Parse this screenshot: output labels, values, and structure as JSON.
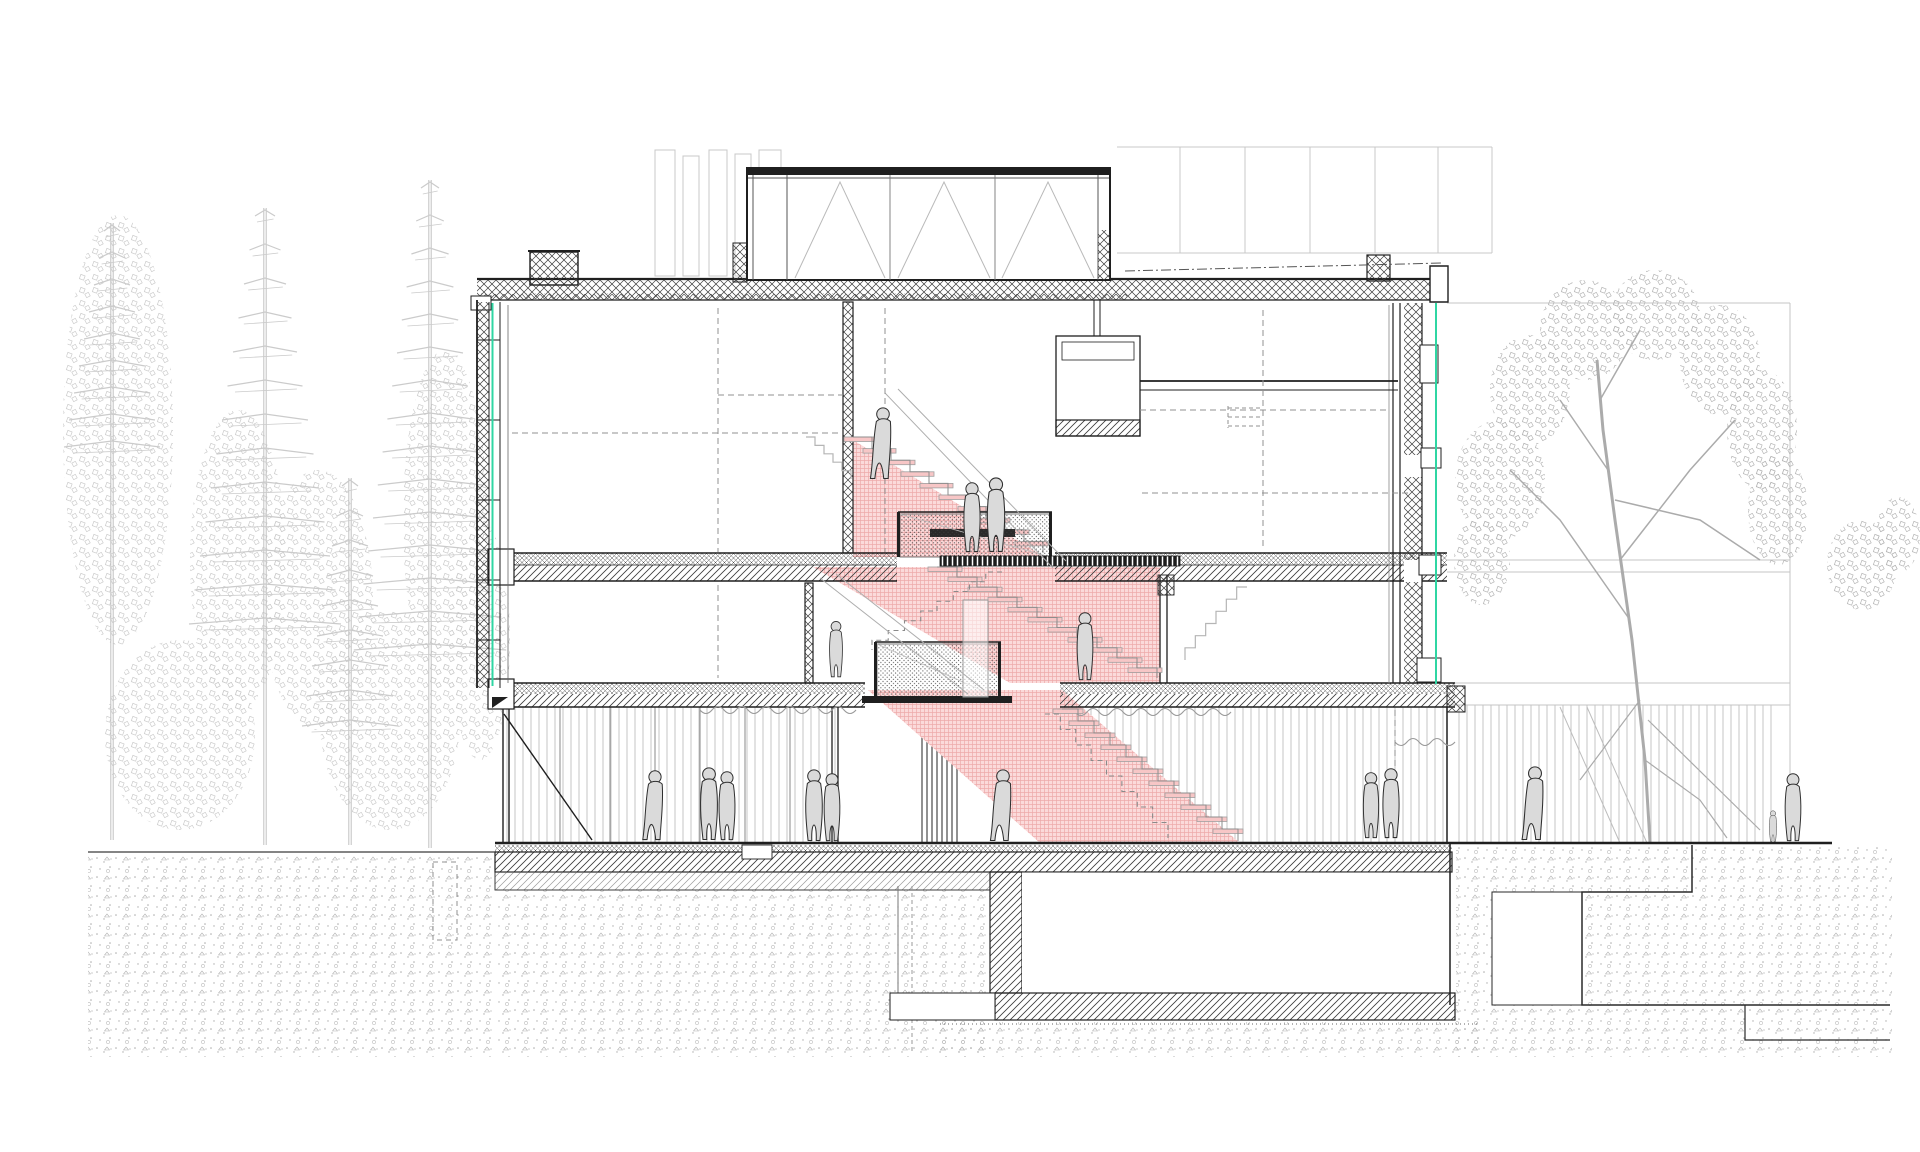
{
  "scene": {
    "description": "Architectural building cross-section drawing: three-storey timber building with a red-highlighted central staircase connecting all levels, basement below grade, conifer forest to the left, deciduous tree and neighbouring building to the right, people silhouettes on every level",
    "drawing_type": "section",
    "building": {
      "storeys": 3,
      "basement": true,
      "clerestory_bays": 3
    },
    "staircase": {
      "visible_flights": 3,
      "hidden_dashed_flights": 2,
      "highlight": "red"
    },
    "people_count": 16,
    "trees": {
      "left_conifers": 4,
      "right_deciduous": 1
    },
    "palette": {
      "line": "#1f1f1f",
      "light_line": "#c7c7c7",
      "tree_left": "#cbcbcb",
      "tree_right": "#aeaeae",
      "people_fill": "#dadada",
      "people_line": "#2f2f2f",
      "stair_mass": "#fbdada",
      "stair_grid": "#eeaaaa",
      "tread_fill": "#f7c6c6",
      "tread_edge": "#a0a0a0",
      "glazing_green": "#2fd6a3",
      "earth_dot": "#ababab",
      "dashed": "#909090"
    },
    "figures": [
      {
        "x": 883,
        "y": 480,
        "h": 74,
        "v": "walk"
      },
      {
        "x": 972,
        "y": 553,
        "h": 72,
        "v": "stand"
      },
      {
        "x": 996,
        "y": 553,
        "h": 77,
        "v": "stand"
      },
      {
        "x": 1085,
        "y": 681,
        "h": 70,
        "v": "stand"
      },
      {
        "x": 836,
        "y": 678,
        "h": 58,
        "v": "stand"
      },
      {
        "x": 655,
        "y": 841,
        "h": 72,
        "v": "walk"
      },
      {
        "x": 709,
        "y": 841,
        "h": 75,
        "v": "stand"
      },
      {
        "x": 727,
        "y": 841,
        "h": 71,
        "v": "stand"
      },
      {
        "x": 814,
        "y": 842,
        "h": 74,
        "v": "stand"
      },
      {
        "x": 832,
        "y": 842,
        "h": 70,
        "v": "stand"
      },
      {
        "x": 1003,
        "y": 842,
        "h": 74,
        "v": "walk"
      },
      {
        "x": 1371,
        "y": 839,
        "h": 68,
        "v": "stand"
      },
      {
        "x": 1391,
        "y": 839,
        "h": 72,
        "v": "stand"
      },
      {
        "x": 1535,
        "y": 841,
        "h": 76,
        "v": "walk"
      },
      {
        "x": 1793,
        "y": 842,
        "h": 70,
        "v": "stand"
      },
      {
        "x": 1773,
        "y": 842,
        "h": 32,
        "v": "stand"
      }
    ],
    "flights_solid": [
      {
        "x0": 853,
        "y0": 437,
        "x1": 1043,
        "y1": 553,
        "n": 10
      },
      {
        "x0": 937,
        "y0": 567,
        "x1": 1157,
        "y1": 678,
        "n": 11
      },
      {
        "x0": 1062,
        "y0": 709,
        "x1": 1238,
        "y1": 841,
        "n": 11
      }
    ],
    "flights_dashed": [
      {
        "x0": 1002,
        "y0": 572,
        "x1": 872,
        "y1": 650,
        "n": 8
      },
      {
        "x0": 1045,
        "y0": 714,
        "x1": 1168,
        "y1": 838,
        "n": 8
      }
    ],
    "flights_background": [
      {
        "x0": 806,
        "y0": 437,
        "x1": 851,
        "y1": 479,
        "n": 5
      },
      {
        "x0": 1247,
        "y0": 587,
        "x1": 1185,
        "y1": 660,
        "n": 6
      }
    ],
    "conifers": [
      {
        "cx": 265,
        "top": 200,
        "bot": 845,
        "tiers": 13,
        "step": 34,
        "w0": 10,
        "grow": 5.5
      },
      {
        "cx": 430,
        "top": 172,
        "bot": 848,
        "tiers": 15,
        "step": 33,
        "w0": 9,
        "grow": 4.8
      },
      {
        "cx": 350,
        "top": 470,
        "bot": 845,
        "tiers": 9,
        "step": 30,
        "w0": 8,
        "grow": 5
      },
      {
        "cx": 112,
        "top": 215,
        "bot": 840,
        "tiers": 9,
        "step": 27,
        "w0": 8,
        "grow": 5
      }
    ],
    "crowns_left": [
      {
        "cx": 118,
        "cy": 430,
        "rx": 55,
        "ry": 215
      },
      {
        "cx": 238,
        "cy": 560,
        "rx": 48,
        "ry": 150
      },
      {
        "cx": 318,
        "cy": 600,
        "rx": 55,
        "ry": 130
      },
      {
        "cx": 445,
        "cy": 520,
        "rx": 42,
        "ry": 170
      },
      {
        "cx": 180,
        "cy": 735,
        "rx": 75,
        "ry": 95
      },
      {
        "cx": 390,
        "cy": 720,
        "rx": 70,
        "ry": 110
      },
      {
        "cx": 480,
        "cy": 640,
        "rx": 30,
        "ry": 120
      }
    ],
    "clusters_right": [
      {
        "cx": 1500,
        "cy": 480,
        "rx": 45,
        "ry": 60
      },
      {
        "cx": 1530,
        "cy": 390,
        "rx": 40,
        "ry": 55
      },
      {
        "cx": 1585,
        "cy": 330,
        "rx": 45,
        "ry": 50
      },
      {
        "cx": 1655,
        "cy": 315,
        "rx": 45,
        "ry": 45
      },
      {
        "cx": 1720,
        "cy": 360,
        "rx": 40,
        "ry": 55
      },
      {
        "cx": 1762,
        "cy": 430,
        "rx": 35,
        "ry": 60
      },
      {
        "cx": 1778,
        "cy": 510,
        "rx": 30,
        "ry": 55
      },
      {
        "cx": 1482,
        "cy": 560,
        "rx": 28,
        "ry": 45
      },
      {
        "cx": 1862,
        "cy": 565,
        "rx": 35,
        "ry": 45
      },
      {
        "cx": 1898,
        "cy": 535,
        "rx": 22,
        "ry": 38
      }
    ]
  }
}
